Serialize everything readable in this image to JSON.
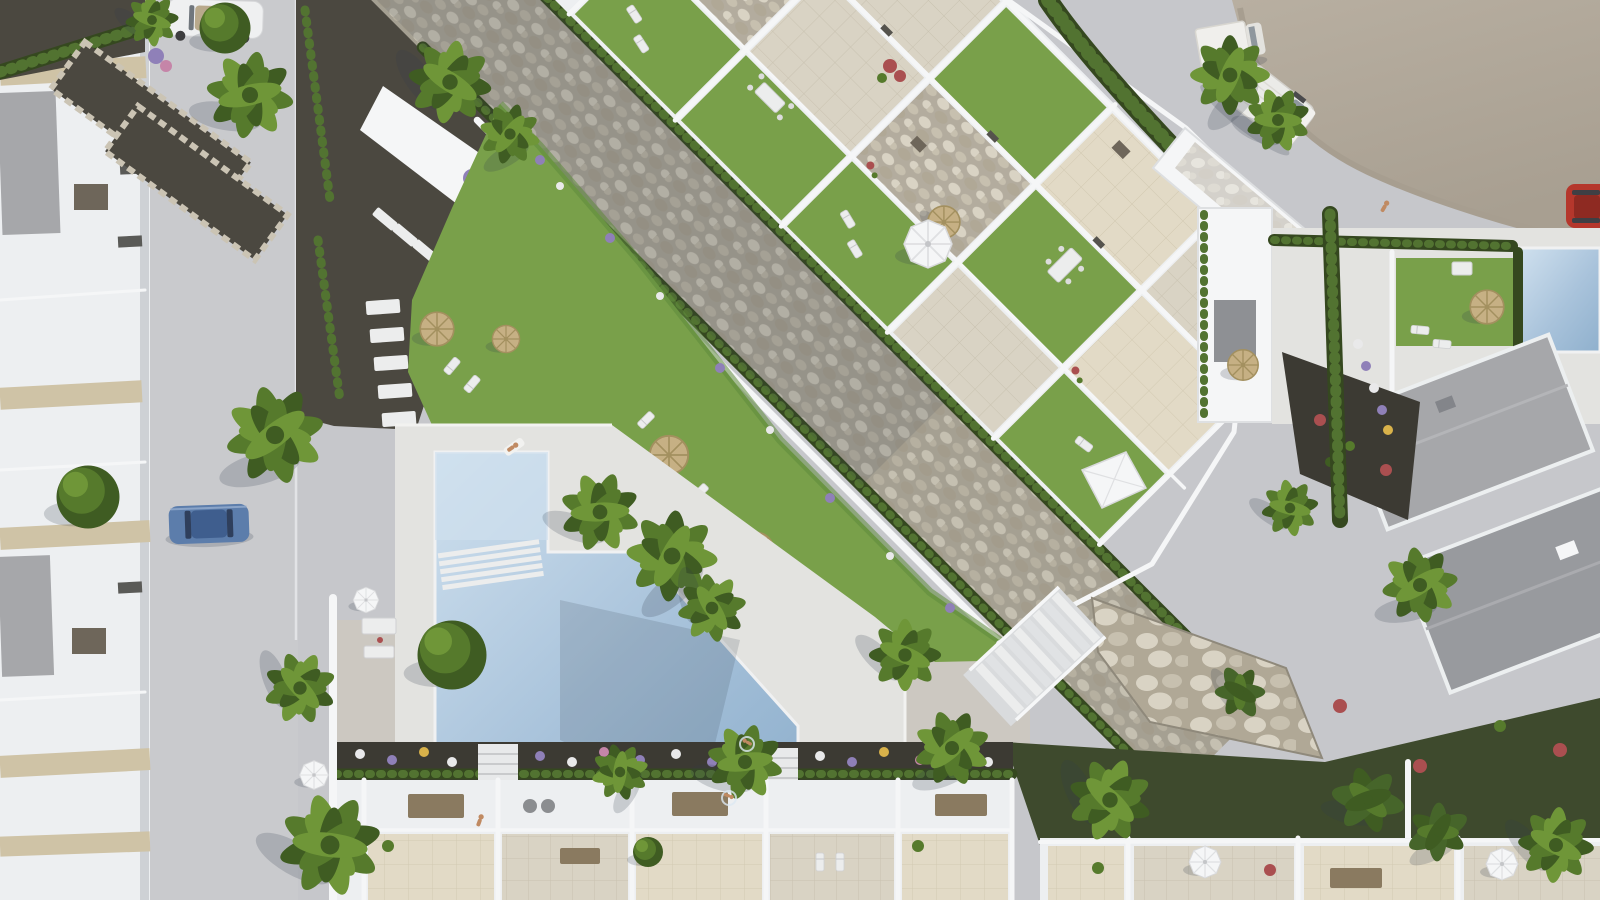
{
  "meta": {
    "caption": "Aerial top-down 3D architectural render of a Mediterranean residential complex with a communal L-shaped pool, landscaped gardens, a pebble dry riverbed, rooftop terraces, streets with parked vehicles and rows of white townhouses.",
    "view": "top-down aerial",
    "sun_direction": "upper-right"
  },
  "palette": {
    "pavement": "#c6c7cb",
    "pavementWarm": "#cdc8bf",
    "roadTan1": "#b8afa1",
    "roadTan2": "#a89f91",
    "kerb": "#e2e3e6",
    "deckWhite": "#e3e3e0",
    "wallWhite": "#f5f6f7",
    "wallShadow": "#b9bdc3",
    "roofWhite": "#edeff1",
    "roofGray": "#a6a7aa",
    "roofGray2": "#989a9e",
    "trimBeige": "#cfc3a6",
    "pergola": "#8a7a60",
    "tileBeige": "#d9d3c4",
    "tileWarm": "#e2dac6",
    "grass": "#79a04a",
    "grassDark": "#5f8a3c",
    "hedge": "#35481f",
    "hedgeLight": "#527331",
    "palm": "#567a2c",
    "palmLight": "#6f9638",
    "palmDark": "#3f5c22",
    "banana": "#46652a",
    "pebbleBase": "#b3ac9e",
    "stone1": "#d9d3c4",
    "stone2": "#c7c0af",
    "stone3": "#b0a896",
    "gravelDark": "#4b4840",
    "soil": "#3c3a33",
    "slopeGreen": "#3e4a2d",
    "poolLight": "#cfe0ee",
    "poolMid": "#a9c3db",
    "poolDeep": "#8fb0cd",
    "stepsWhite": "#eceded",
    "strawTop": "#c6b084",
    "strawEdge": "#a3905f",
    "flowerPurple": "#8f80b8",
    "flowerWhite": "#e9e9ea",
    "flowerPink": "#c585a8",
    "flowerRed": "#aa4f50",
    "flowerYellow": "#d9b24a",
    "skin": "#c08a62",
    "carBlue": "#5c7dab",
    "carBlueDark": "#3f5e8e",
    "carRed": "#b5372c",
    "carRedDark": "#8e2a22",
    "vanWhite": "#ebebe8",
    "vanShade": "#d5d3cd",
    "boxBrown": "#6e665a",
    "glass": "#8f979e",
    "shadowC": "rgba(52,60,74,0.20)"
  },
  "scene": {
    "streets": {
      "west_street": {
        "parked_vehicles": [
          "blue-hatchback",
          "white-convertible"
        ]
      },
      "north_parking_area": {
        "vehicles": [
          "white-van",
          "white-box-truck",
          "red-car"
        ],
        "pedestrians": 1
      }
    },
    "amenities": {
      "communal_pool": {
        "shape": "L-shaped with diagonal edge",
        "steps": true,
        "swimmers": 2
      },
      "sun_lawn": {
        "straw_parasols": 4,
        "loungers": 5
      },
      "pool_deck": {
        "sunbathers": 1,
        "walkers": 1
      }
    },
    "buildings": {
      "west_townhouse_row": {
        "style": "white with beige trim",
        "ac_units": 2
      },
      "central_apartment_block": {
        "orientation_deg": 45,
        "roof_gardens": 6,
        "white_parasols": 1,
        "canopy_tents": 1
      },
      "south_townhouse_row": {
        "units": 5,
        "pergolas": 3
      },
      "east_villas": {
        "gray_roofs": 2,
        "private_pool": true,
        "straw_parasols": 2,
        "white_parasols": 2
      }
    },
    "landscape": {
      "dry_riverbed": "diagonal pebble strip between hedges",
      "retaining_wall": "stone wall with white staircase",
      "palm_trees": 18,
      "round_trees": 3,
      "flower_colors": [
        "purple",
        "white",
        "pink",
        "red",
        "yellow"
      ]
    }
  }
}
